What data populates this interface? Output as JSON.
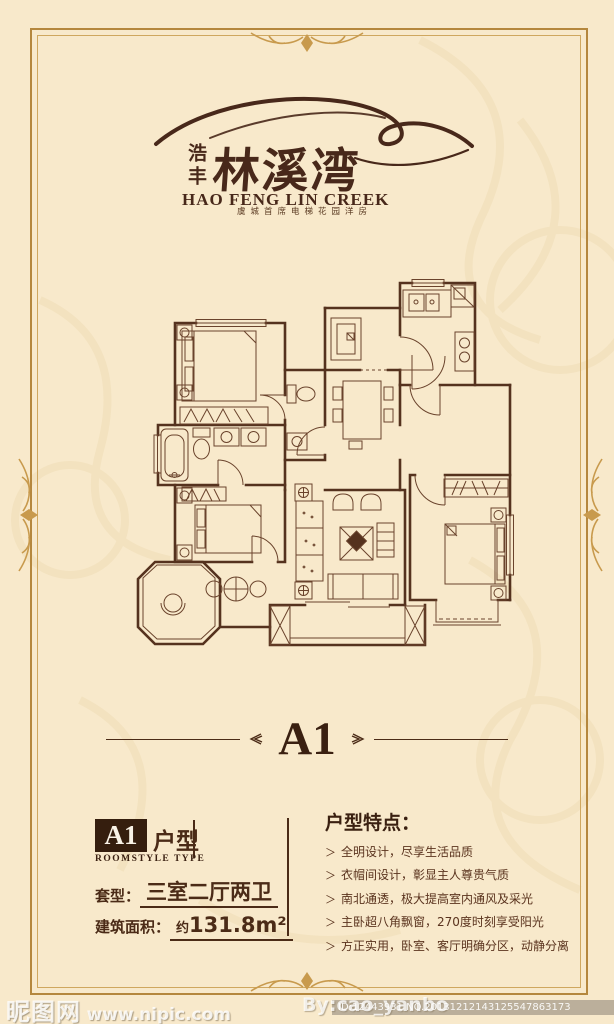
{
  "logo": {
    "seal": "浩丰",
    "brand": "林溪湾",
    "english": "HAO FENG LIN CREEK",
    "tagline": "虞城首席电梯花园洋房"
  },
  "plan_heading": {
    "title": "A1"
  },
  "unit_info": {
    "badge": "A1",
    "badge_label": "户型",
    "badge_sub": "ROOMSTYLE TYPE",
    "type_label": "套型：",
    "type_value": "三室二厅两卫",
    "area_label": "建筑面积：",
    "area_approx": "约",
    "area_value": "131.8m²"
  },
  "features": {
    "title": "户型特点：",
    "marker": "＞",
    "items": [
      "全明设计，尽享生活品质",
      "衣帽间设计，彰显主人尊贵气质",
      "南北通透，极大提高室内通风及采光",
      "主卧超八角飘窗，270度时刻享受阳光",
      "方正实用，卧室、客厅明确分区，动静分离"
    ]
  },
  "watermarks": {
    "site_name": "昵图网",
    "site_url": "www.nipic.com",
    "author": "By:cao_yanbo",
    "id_line": "ID:12443931 NO.20131212143125547863173"
  },
  "colors": {
    "background": "#f8e9cb",
    "frame_gold": "#b5873d",
    "ink_brown": "#4b2b17",
    "badge_bg": "#351e0e",
    "plan_line": "#55321e"
  }
}
